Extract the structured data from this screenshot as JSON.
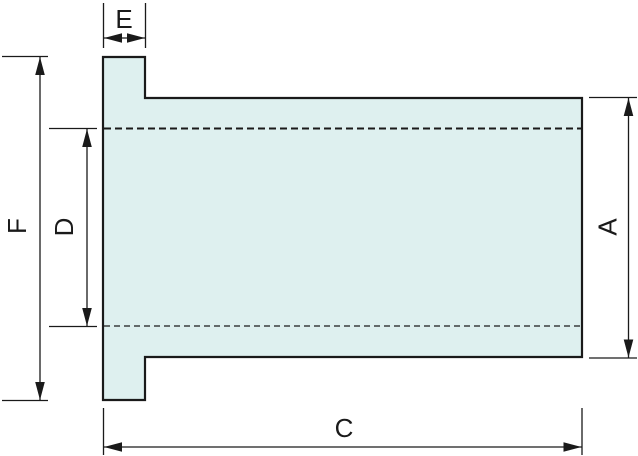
{
  "diagram": {
    "labels": {
      "flange_thickness": "E",
      "flange_outer_diameter": "F",
      "bore_diameter": "D",
      "body_outer_diameter": "A",
      "overall_length": "C"
    },
    "colors": {
      "part_fill": "#def0ef",
      "line": "#1a1a1a",
      "background": "#ffffff"
    }
  }
}
